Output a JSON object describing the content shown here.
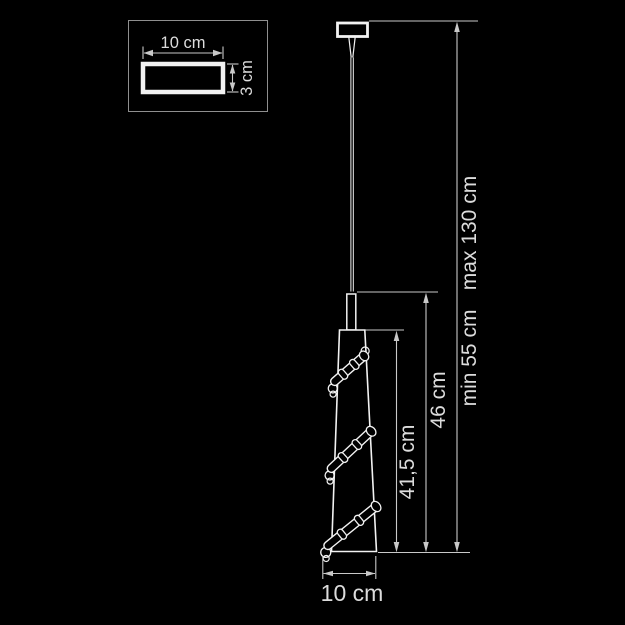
{
  "detail_view": {
    "width_label": "10 cm",
    "height_label": "3 cm"
  },
  "dimensions": {
    "shade_length_label": "41,5 cm",
    "body_length_label": "46 cm",
    "min_length_label": "min 55 cm",
    "max_length_label": "max 130 cm",
    "diameter_label": "10 cm"
  },
  "colors": {
    "background": "#000000",
    "outline": "#f2f2f2",
    "dimension_line": "#c9c9c9",
    "text": "#dcdcdc",
    "inset_border": "#8f8f8f"
  }
}
